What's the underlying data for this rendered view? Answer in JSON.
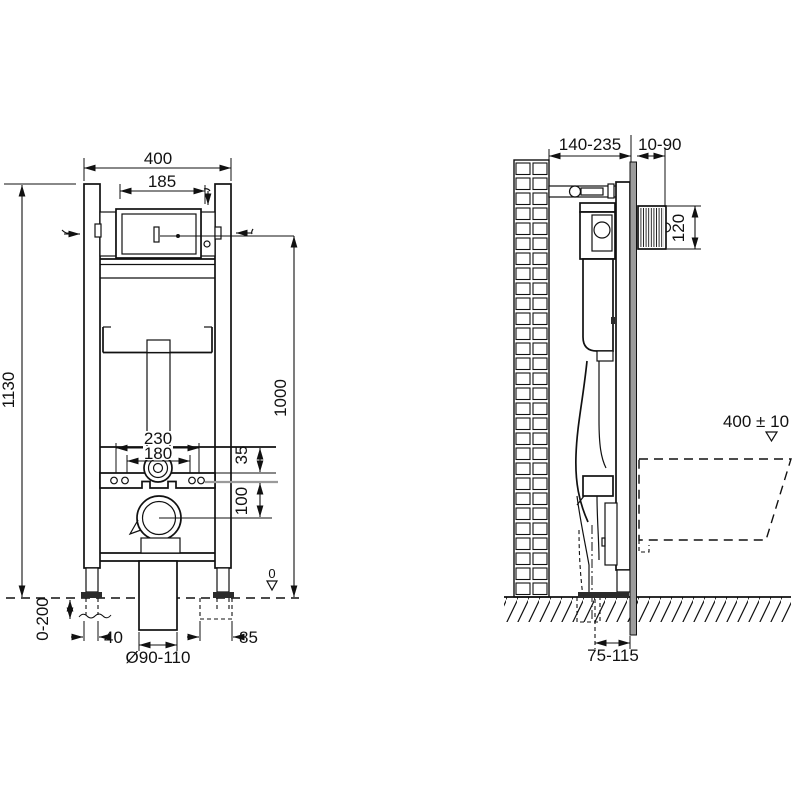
{
  "drawing": {
    "type": "installation-frame-technical-drawing",
    "front_view": {
      "dim_overall_width": "400",
      "dim_cistern_width": "185",
      "dim_frame_height": "1130",
      "dim_actuator_center_height": "1000",
      "dim_fixing_width_outer": "230",
      "dim_fixing_width_inner": "180",
      "dim_supply_offset": "35",
      "dim_outlet_offset": "100",
      "datum_zero": "0",
      "dim_leg_adjustment": "0-200",
      "dim_foot_left": "40",
      "dim_outlet_diameter": "Ø90-110",
      "dim_foot_right": "85"
    },
    "side_view": {
      "dim_frame_depth": "140-235",
      "dim_wall_finish_depth": "10-90",
      "dim_actuator_opening_height": "120",
      "dim_bowl_top_height": "400 ± 10",
      "dim_outlet_floor_distance": "75-115"
    },
    "colors": {
      "line": "#111111",
      "panel_gray": "#9c9c9c",
      "reference_gray": "#9a9a9a",
      "background": "#ffffff"
    }
  }
}
